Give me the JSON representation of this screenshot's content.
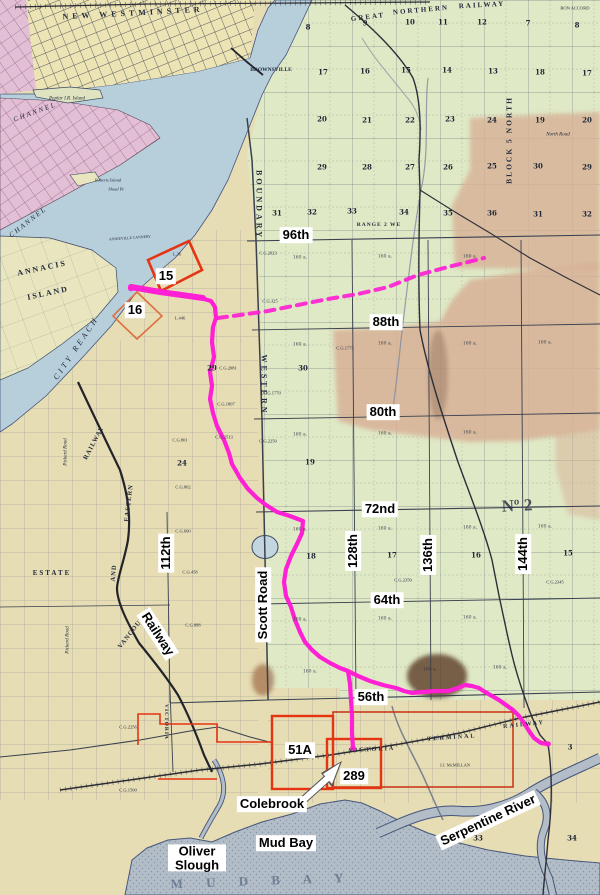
{
  "map": {
    "colors": {
      "route_magenta": "#ff1fd4",
      "parcel_red": "#e53411",
      "parcel_orange": "#dd7040",
      "water_blue": "#b7cedb",
      "mud_bay_gray": "#b2bdc8",
      "land_tan": "#e6ddb4",
      "land_green": "#dfe9c6",
      "rose_patch": "#d7b096",
      "city_pink": "#e2bfd4",
      "label_bg": "#ffffff",
      "label_text": "#000000",
      "map_line": "#39404f"
    },
    "overlay_labels": [
      {
        "name": "street-label-96th",
        "text": "96th",
        "x": 296,
        "y": 235,
        "rot": 0
      },
      {
        "name": "street-label-88th",
        "text": "88th",
        "x": 386,
        "y": 322,
        "rot": 0
      },
      {
        "name": "street-label-80th",
        "text": "80th",
        "x": 383,
        "y": 412,
        "rot": 0
      },
      {
        "name": "street-label-72nd",
        "text": "72nd",
        "x": 380,
        "y": 509,
        "rot": 0
      },
      {
        "name": "street-label-64th",
        "text": "64th",
        "x": 387,
        "y": 600,
        "rot": 0
      },
      {
        "name": "street-label-56th",
        "text": "56th",
        "x": 371,
        "y": 697,
        "rot": 0
      },
      {
        "name": "street-label-112th",
        "text": "112th",
        "x": 166,
        "y": 553,
        "rot": -90
      },
      {
        "name": "street-label-128th",
        "text": "128th",
        "x": 353,
        "y": 551,
        "rot": -90
      },
      {
        "name": "street-label-136th",
        "text": "136th",
        "x": 428,
        "y": 555,
        "rot": -90
      },
      {
        "name": "street-label-144th",
        "text": "144th",
        "x": 523,
        "y": 554,
        "rot": -90
      },
      {
        "name": "street-label-scott-road",
        "text": "Scott Road",
        "x": 263,
        "y": 605,
        "rot": -90
      },
      {
        "name": "street-label-railway",
        "text": "Railway",
        "x": 158,
        "y": 634,
        "rot": 57
      },
      {
        "name": "place-label-serpentine-river",
        "text": "Serpentine River",
        "x": 488,
        "y": 820,
        "rot": -25
      },
      {
        "name": "parcel-label-15",
        "text": "15",
        "x": 166,
        "y": 276,
        "rot": 0
      },
      {
        "name": "parcel-label-16",
        "text": "16",
        "x": 135,
        "y": 310,
        "rot": 0
      },
      {
        "name": "parcel-label-51a",
        "text": "51A",
        "x": 300,
        "y": 750,
        "rot": 0
      },
      {
        "name": "parcel-label-289",
        "text": "289",
        "x": 354,
        "y": 776,
        "rot": 0
      },
      {
        "name": "place-label-colebrook",
        "text": "Colebrook",
        "x": 272,
        "y": 804,
        "rot": 0
      },
      {
        "name": "place-label-mud-bay",
        "text": "Mud Bay",
        "x": 286,
        "y": 843,
        "rot": 0
      },
      {
        "name": "place-label-oliver-slough",
        "text": "Oliver Slough",
        "x": 197,
        "y": 858,
        "rot": 0,
        "w": 52
      }
    ],
    "map_texts": [
      {
        "name": "text-new-westminster",
        "t": "NEW  WESTMINSTER",
        "x": 133,
        "y": 13,
        "rot": -3,
        "fs": 8,
        "ls": 4,
        "b": 1
      },
      {
        "name": "text-great",
        "t": "GREAT",
        "x": 368,
        "y": 17,
        "rot": -7,
        "fs": 7,
        "ls": 2,
        "b": 1
      },
      {
        "name": "text-northern",
        "t": "NORTHERN",
        "x": 421,
        "y": 10,
        "rot": -5,
        "fs": 7,
        "ls": 2,
        "b": 1
      },
      {
        "name": "text-railway-top",
        "t": "RAILWAY",
        "x": 482,
        "y": 5,
        "rot": -3,
        "fs": 7,
        "ls": 2,
        "b": 1
      },
      {
        "name": "text-bon-accord",
        "t": "BON ACCORD",
        "x": 575,
        "y": 8,
        "rot": 0,
        "fs": 4.5
      },
      {
        "name": "text-brownsville",
        "t": "BROWNSVILLE",
        "x": 271,
        "y": 70,
        "rot": 0,
        "fs": 5.5,
        "b": 1
      },
      {
        "name": "text-channel-upper",
        "t": "CHANNEL",
        "x": 35,
        "y": 112,
        "rot": -20,
        "fs": 7,
        "it": 1,
        "ls": 2
      },
      {
        "name": "text-channel-lower",
        "t": "CHANNEL",
        "x": 28,
        "y": 222,
        "rot": -38,
        "fs": 7,
        "it": 1,
        "ls": 2
      },
      {
        "name": "text-annacis",
        "t": "ANNACIS",
        "x": 42,
        "y": 268,
        "rot": -12,
        "fs": 8,
        "ls": 2,
        "b": 1
      },
      {
        "name": "text-island",
        "t": "ISLAND",
        "x": 48,
        "y": 293,
        "rot": -12,
        "fs": 8,
        "ls": 2,
        "b": 1
      },
      {
        "name": "text-city-reach",
        "t": "CITY  REACH",
        "x": 76,
        "y": 348,
        "rot": -56,
        "fs": 8,
        "it": 1,
        "ls": 3
      },
      {
        "name": "text-poplar-island",
        "t": "Poplar I.R. Island",
        "x": 67,
        "y": 99,
        "rot": 0,
        "fs": 5,
        "it": 1
      },
      {
        "name": "text-roberts-island",
        "t": "Roberts Island",
        "x": 108,
        "y": 180,
        "rot": 0,
        "fs": 4.5,
        "it": 1
      },
      {
        "name": "text-shoal-pt",
        "t": "Shoal Pt",
        "x": 116,
        "y": 189,
        "rot": 0,
        "fs": 4.5,
        "it": 1
      },
      {
        "name": "text-annieville-cannery",
        "t": "ANNIEVILLE CANNERY",
        "x": 130,
        "y": 238,
        "rot": -4,
        "fs": 3.8
      },
      {
        "name": "text-boundary-road",
        "t": "BOUNDARY",
        "x": 259,
        "y": 205,
        "rot": 90,
        "fs": 8,
        "ls": 3,
        "b": 1
      },
      {
        "name": "text-western-road",
        "t": "WESTERN",
        "x": 264,
        "y": 385,
        "rot": 90,
        "fs": 8,
        "ls": 3,
        "b": 1
      },
      {
        "name": "text-range-2",
        "t": "RANGE 2 WE",
        "x": 379,
        "y": 225,
        "rot": 0,
        "fs": 5.5,
        "ls": 1,
        "b": 1
      },
      {
        "name": "text-block-5-north",
        "t": "BLOCK 5 NORTH",
        "x": 509,
        "y": 140,
        "rot": -90,
        "fs": 7.5,
        "ls": 2,
        "b": 1
      },
      {
        "name": "text-north-road",
        "t": "North Road",
        "x": 558,
        "y": 135,
        "rot": 0,
        "fs": 5,
        "it": 1
      },
      {
        "name": "text-township-no2",
        "t": "Nº 2",
        "x": 517,
        "y": 506,
        "rot": -3,
        "fs": 17,
        "b": 1,
        "op": 0.8
      },
      {
        "name": "text-estate",
        "t": "ESTATE",
        "x": 52,
        "y": 573,
        "rot": 0,
        "fs": 7,
        "ls": 2,
        "b": 1
      },
      {
        "name": "text-pickard-road-1",
        "t": "Pickard Road",
        "x": 66,
        "y": 452,
        "rot": -90,
        "fs": 5,
        "it": 1
      },
      {
        "name": "text-pickard-road-2",
        "t": "Pickard Road",
        "x": 68,
        "y": 640,
        "rot": -90,
        "fs": 5,
        "it": 1
      },
      {
        "name": "text-vve-railway",
        "t": "RAILWAY",
        "x": 94,
        "y": 443,
        "rot": -62,
        "fs": 6.5,
        "ls": 1,
        "b": 1
      },
      {
        "name": "text-vve-eastern",
        "t": "EASTERN",
        "x": 129,
        "y": 503,
        "rot": -83,
        "fs": 6.5,
        "ls": 1,
        "b": 1
      },
      {
        "name": "text-vve-and",
        "t": "AND",
        "x": 114,
        "y": 573,
        "rot": -85,
        "fs": 6.5,
        "ls": 1,
        "b": 1
      },
      {
        "name": "text-vve-vancouver",
        "t": "VANCOUVER",
        "x": 135,
        "y": 628,
        "rot": -52,
        "fs": 6.5,
        "ls": 1,
        "b": 1
      },
      {
        "name": "text-victoria-road",
        "t": "VICTORIA",
        "x": 166,
        "y": 722,
        "rot": 90,
        "fs": 5.5,
        "ls": 1,
        "b": 1
      },
      {
        "name": "text-vtr-victoria",
        "t": "VICTORIA",
        "x": 372,
        "y": 750,
        "rot": -3,
        "fs": 6,
        "ls": 2,
        "b": 1
      },
      {
        "name": "text-vtr-terminal",
        "t": "TERMINAL",
        "x": 452,
        "y": 738,
        "rot": -4,
        "fs": 6,
        "ls": 2,
        "b": 1
      },
      {
        "name": "text-vtr-railway",
        "t": "RAILWAY",
        "x": 524,
        "y": 725,
        "rot": -6,
        "fs": 6,
        "ls": 2,
        "b": 1
      },
      {
        "name": "text-mud-bay-big",
        "t": "M U D   B A Y",
        "x": 262,
        "y": 881,
        "rot": -2,
        "fs": 13,
        "ls": 10,
        "col": "rgba(50,70,95,0.5)",
        "b": 1
      },
      {
        "name": "text-landowner",
        "t": "J.J. McMILLAN",
        "x": 455,
        "y": 765,
        "rot": 0,
        "fs": 4.5
      },
      {
        "name": "text-l36",
        "t": "L.36",
        "x": 177,
        "y": 254,
        "rot": 0,
        "fs": 4.5
      },
      {
        "name": "text-l446",
        "t": "L.446",
        "x": 180,
        "y": 318,
        "rot": 0,
        "fs": 4.5
      },
      {
        "name": "text-cg-1",
        "t": "C.G.2023",
        "x": 268,
        "y": 253,
        "rot": 0,
        "fs": 4.5
      },
      {
        "name": "text-cg-2",
        "t": "C.G.325",
        "x": 270,
        "y": 301,
        "rot": 0,
        "fs": 4.5
      },
      {
        "name": "text-cg-3",
        "t": "C.G.1775",
        "x": 345,
        "y": 348,
        "rot": 0,
        "fs": 4.5
      },
      {
        "name": "text-cg-4",
        "t": "C.G.1770",
        "x": 272,
        "y": 393,
        "rot": 0,
        "fs": 4.5
      },
      {
        "name": "text-cg-5",
        "t": "C.G.2081",
        "x": 228,
        "y": 368,
        "rot": 0,
        "fs": 4.5
      },
      {
        "name": "text-cg-6",
        "t": "C.G.1807",
        "x": 226,
        "y": 404,
        "rot": 0,
        "fs": 4.5
      },
      {
        "name": "text-cg-7",
        "t": "C.G.2513",
        "x": 224,
        "y": 437,
        "rot": 0,
        "fs": 4.5
      },
      {
        "name": "text-cg-8",
        "t": "C.G.2250",
        "x": 268,
        "y": 441,
        "rot": 0,
        "fs": 4.5
      },
      {
        "name": "text-cg-9",
        "t": "C.G.801",
        "x": 180,
        "y": 440,
        "rot": 0,
        "fs": 4.5
      },
      {
        "name": "text-cg-10",
        "t": "C.G.802",
        "x": 183,
        "y": 487,
        "rot": 0,
        "fs": 4.5
      },
      {
        "name": "text-cg-11",
        "t": "C.G.660",
        "x": 183,
        "y": 531,
        "rot": 0,
        "fs": 4.5
      },
      {
        "name": "text-cg-12",
        "t": "C.G.458",
        "x": 190,
        "y": 572,
        "rot": 0,
        "fs": 4.5
      },
      {
        "name": "text-cg-13",
        "t": "C.G.888",
        "x": 193,
        "y": 625,
        "rot": 0,
        "fs": 4.5
      },
      {
        "name": "text-cg-14",
        "t": "C.G.2350",
        "x": 403,
        "y": 580,
        "rot": 0,
        "fs": 4.5
      },
      {
        "name": "text-cg-15",
        "t": "C.G.2345",
        "x": 555,
        "y": 582,
        "rot": 0,
        "fs": 4.5
      },
      {
        "name": "text-cg-16",
        "t": "C.G.2256",
        "x": 128,
        "y": 727,
        "rot": 0,
        "fs": 4.5
      },
      {
        "name": "text-cg-17",
        "t": "C.G.1500",
        "x": 128,
        "y": 790,
        "rot": 0,
        "fs": 4.5
      }
    ],
    "acre_labels": [
      {
        "t": "160 a.",
        "x": 300,
        "y": 258
      },
      {
        "t": "160 a.",
        "x": 385,
        "y": 257
      },
      {
        "t": "160 a.",
        "x": 470,
        "y": 257
      },
      {
        "t": "160 a.",
        "x": 300,
        "y": 345
      },
      {
        "t": "160 a.",
        "x": 385,
        "y": 344
      },
      {
        "t": "160 a.",
        "x": 470,
        "y": 344
      },
      {
        "t": "160 a.",
        "x": 545,
        "y": 343
      },
      {
        "t": "160 a.",
        "x": 300,
        "y": 435
      },
      {
        "t": "160 a.",
        "x": 385,
        "y": 434
      },
      {
        "t": "160 a.",
        "x": 470,
        "y": 433
      },
      {
        "t": "160 a.",
        "x": 300,
        "y": 530
      },
      {
        "t": "160 a.",
        "x": 385,
        "y": 529
      },
      {
        "t": "160 a.",
        "x": 470,
        "y": 528
      },
      {
        "t": "160 a.",
        "x": 545,
        "y": 527
      },
      {
        "t": "160 a.",
        "x": 300,
        "y": 620
      },
      {
        "t": "160 a.",
        "x": 385,
        "y": 619
      },
      {
        "t": "160 a.",
        "x": 470,
        "y": 618
      },
      {
        "t": "160 a.",
        "x": 310,
        "y": 672
      },
      {
        "t": "160 a.",
        "x": 430,
        "y": 670
      },
      {
        "t": "160 a.",
        "x": 500,
        "y": 668
      }
    ],
    "section_numbers": [
      {
        "t": "8",
        "x": 308,
        "y": 27
      },
      {
        "t": "9",
        "x": 365,
        "y": 23
      },
      {
        "t": "10",
        "x": 410,
        "y": 22
      },
      {
        "t": "11",
        "x": 443,
        "y": 22
      },
      {
        "t": "12",
        "x": 482,
        "y": 22
      },
      {
        "t": "7",
        "x": 528,
        "y": 23
      },
      {
        "t": "8",
        "x": 577,
        "y": 25
      },
      {
        "t": "17",
        "x": 323,
        "y": 72
      },
      {
        "t": "16",
        "x": 365,
        "y": 71
      },
      {
        "t": "15",
        "x": 406,
        "y": 70
      },
      {
        "t": "14",
        "x": 447,
        "y": 70
      },
      {
        "t": "13",
        "x": 493,
        "y": 71
      },
      {
        "t": "18",
        "x": 540,
        "y": 72
      },
      {
        "t": "17",
        "x": 587,
        "y": 73
      },
      {
        "t": "20",
        "x": 322,
        "y": 119
      },
      {
        "t": "21",
        "x": 367,
        "y": 120
      },
      {
        "t": "22",
        "x": 410,
        "y": 120
      },
      {
        "t": "23",
        "x": 450,
        "y": 119
      },
      {
        "t": "24",
        "x": 492,
        "y": 120
      },
      {
        "t": "19",
        "x": 540,
        "y": 120
      },
      {
        "t": "20",
        "x": 587,
        "y": 120
      },
      {
        "t": "29",
        "x": 322,
        "y": 167
      },
      {
        "t": "28",
        "x": 367,
        "y": 167
      },
      {
        "t": "27",
        "x": 410,
        "y": 167
      },
      {
        "t": "26",
        "x": 448,
        "y": 167
      },
      {
        "t": "25",
        "x": 492,
        "y": 166
      },
      {
        "t": "30",
        "x": 538,
        "y": 166
      },
      {
        "t": "29",
        "x": 587,
        "y": 167
      },
      {
        "t": "31",
        "x": 277,
        "y": 213
      },
      {
        "t": "32",
        "x": 312,
        "y": 212
      },
      {
        "t": "33",
        "x": 352,
        "y": 211
      },
      {
        "t": "34",
        "x": 404,
        "y": 212
      },
      {
        "t": "35",
        "x": 448,
        "y": 213
      },
      {
        "t": "36",
        "x": 492,
        "y": 213
      },
      {
        "t": "31",
        "x": 538,
        "y": 214
      },
      {
        "t": "32",
        "x": 587,
        "y": 214
      },
      {
        "t": "29",
        "x": 212,
        "y": 368
      },
      {
        "t": "30",
        "x": 303,
        "y": 368
      },
      {
        "t": "24",
        "x": 182,
        "y": 463
      },
      {
        "t": "19",
        "x": 310,
        "y": 462
      },
      {
        "t": "18",
        "x": 311,
        "y": 556
      },
      {
        "t": "17",
        "x": 392,
        "y": 555
      },
      {
        "t": "16",
        "x": 476,
        "y": 555
      },
      {
        "t": "15",
        "x": 568,
        "y": 553
      },
      {
        "t": "3",
        "x": 570,
        "y": 747
      },
      {
        "t": "34",
        "x": 572,
        "y": 838
      },
      {
        "t": "33",
        "x": 478,
        "y": 838
      }
    ]
  }
}
